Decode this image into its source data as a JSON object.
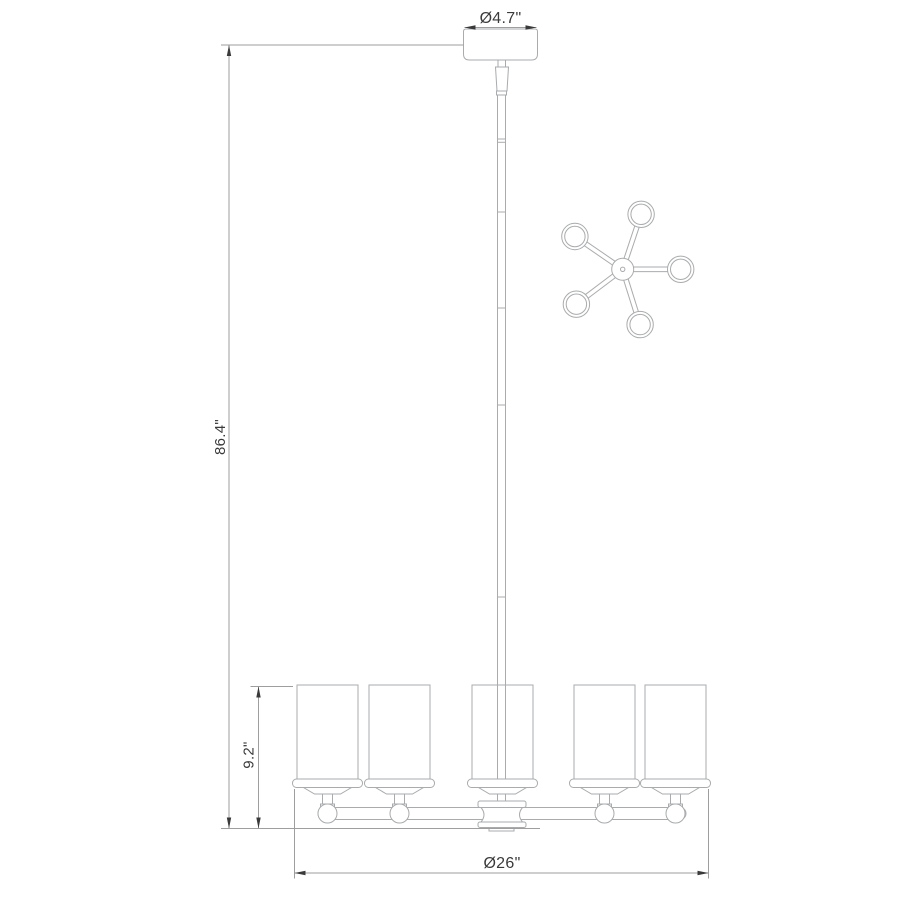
{
  "colors": {
    "background": "#ffffff",
    "line": "#a9abad",
    "dimension_line": "#9e9e9e",
    "arrow": "#3a3a3a",
    "text": "#3a3a3a"
  },
  "dimensions": {
    "canopy_diameter": "Ø4.7\"",
    "overall_height": "86.4\"",
    "shade_height": "9.2\"",
    "fixture_diameter": "Ø26\""
  },
  "views": {
    "side_view": "chandelier-side-elevation",
    "top_view": "chandelier-top-plan-5-arm"
  }
}
